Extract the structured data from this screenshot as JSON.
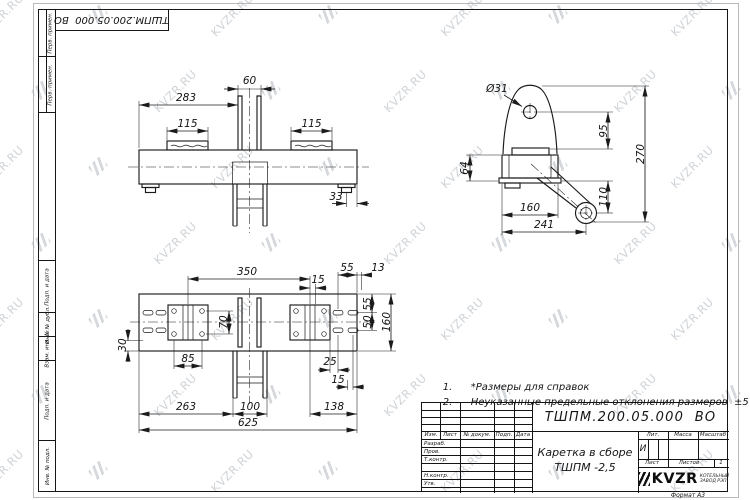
{
  "watermark": {
    "text": "KVZR.RU"
  },
  "stamp": {
    "designation": "ТШПМ.200.05.000  ВО"
  },
  "margin": {
    "top": [
      "Перв. примен.",
      "Перв. примен."
    ],
    "bottom": [
      "Подп. и дата",
      "Инв. № дубл.",
      "Взам. инв. №",
      "Подп. и дата",
      "Инв. № подл."
    ]
  },
  "views": {
    "front": {
      "d283": "283",
      "d60": "60",
      "d115L": "115",
      "d115R": "115",
      "d33": "33"
    },
    "side": {
      "dia31": "Ø31",
      "d95": "95",
      "d270": "270",
      "d64": "64",
      "d110": "110",
      "d160": "160",
      "d241": "241"
    },
    "plan": {
      "d350": "350",
      "d15top": "15",
      "d55top": "55",
      "d13": "13",
      "d55r": "55",
      "d50r": "50",
      "d160r": "160",
      "d70": "70",
      "d30": "30",
      "d85": "85",
      "d25": "25",
      "d15b": "15",
      "d263": "263",
      "d100": "100",
      "d138": "138",
      "d625": "625"
    }
  },
  "notes": [
    {
      "num": "1.",
      "text": "*Размеры для справок"
    },
    {
      "num": "2.",
      "text": "Неуказанные предельные отклонения размеров  ±5 мм."
    }
  ],
  "title_block": {
    "designation": "ТШПМ.200.05.000  ВО",
    "name_line1": "Каретка в сборе",
    "name_line2": "ТШПМ -2,5",
    "cols": {
      "izm": "Изм.",
      "list": "Лист",
      "doc": "№ докум.",
      "sign": "Подп.",
      "date": "Дата"
    },
    "rows": [
      "Разраб.",
      "Пров.",
      "Т.контр.",
      "Н.контр.",
      "Утв."
    ],
    "lit_label": "Лит.",
    "lit_value": "И",
    "mass_label": "Масса",
    "scale_label": "Масштаб",
    "sheet_label": "Лист",
    "sheets_label": "Листов",
    "sheets_value": "1",
    "logo_text": "KVZR",
    "logo_sub1": "КОТЕЛЬНЫЙ",
    "logo_sub2": "ЗАВОД РЭП",
    "format": "Формат А3"
  }
}
